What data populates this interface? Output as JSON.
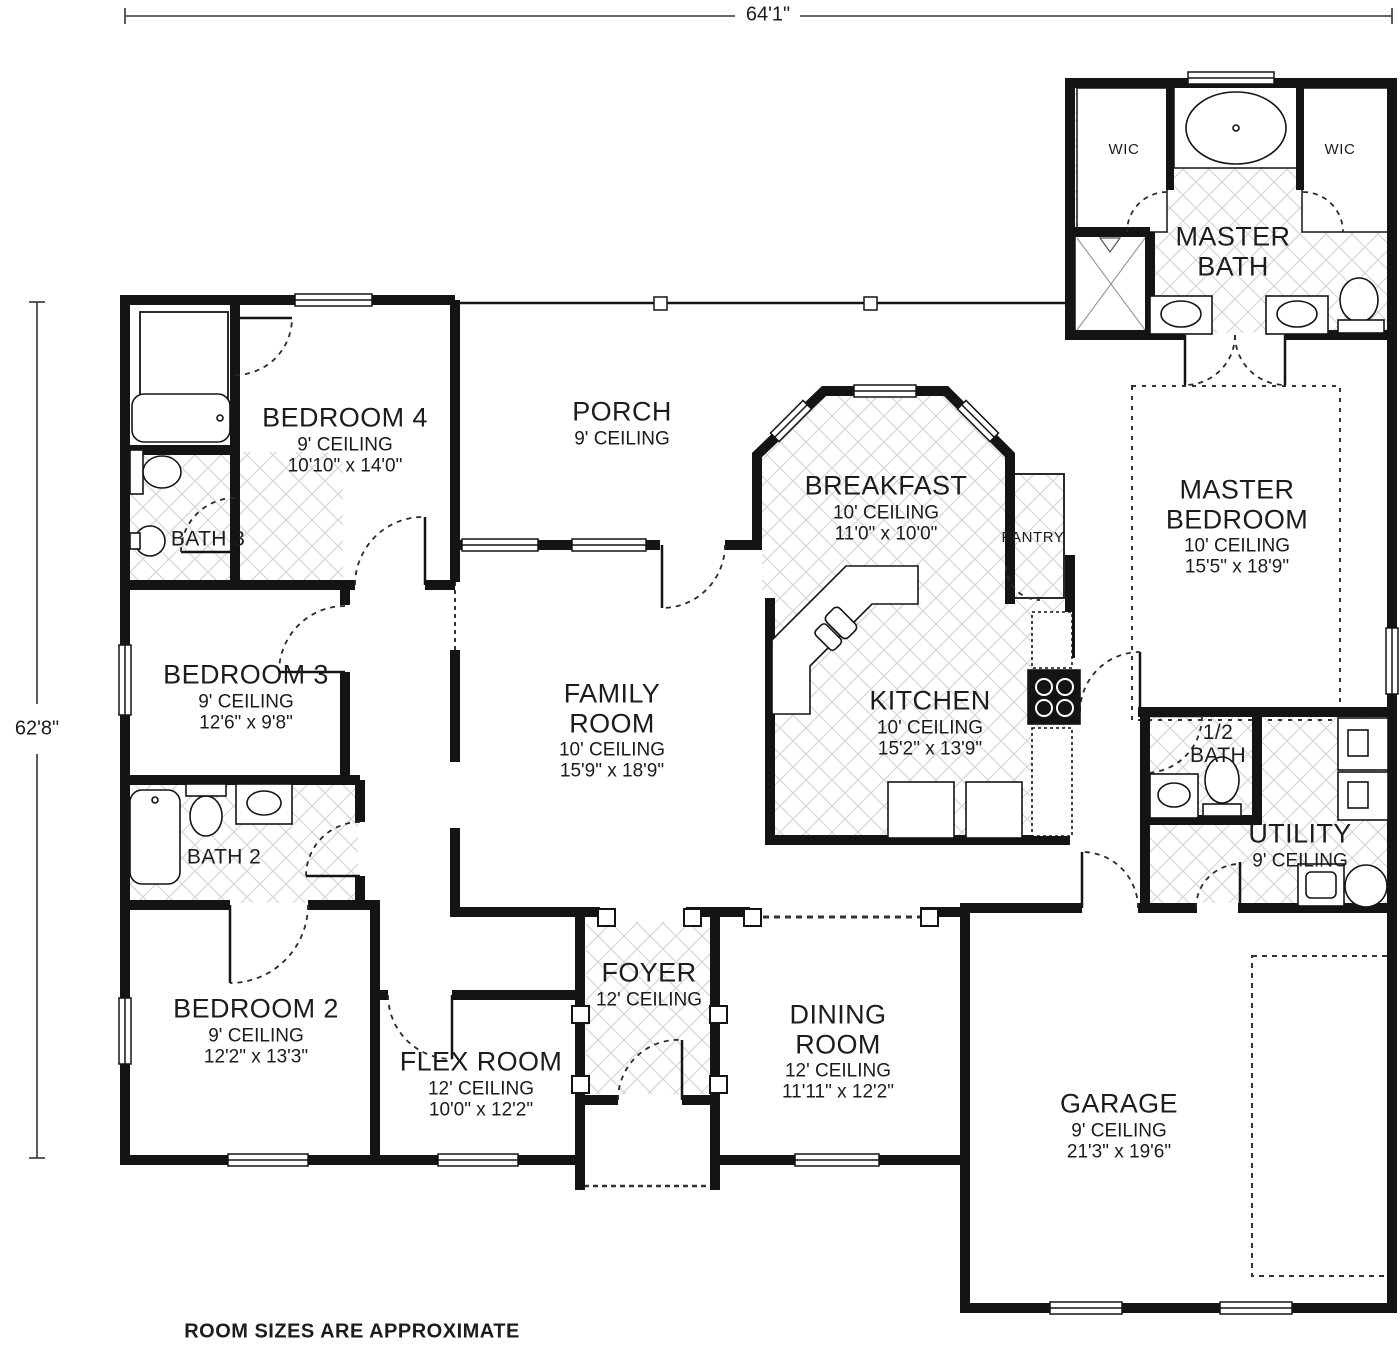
{
  "dimensions": {
    "overall_width": "64'1\"",
    "overall_height": "62'8\""
  },
  "footnote": "ROOM SIZES ARE APPROXIMATE",
  "rooms": {
    "master_bath": {
      "name": [
        "MASTER",
        "BATH"
      ],
      "details": []
    },
    "wic_left": {
      "name": [
        "WIC"
      ],
      "details": []
    },
    "wic_right": {
      "name": [
        "WIC"
      ],
      "details": []
    },
    "bedroom4": {
      "name": [
        "BEDROOM 4"
      ],
      "details": [
        "9' CEILING",
        "10'10\" x 14'0\""
      ]
    },
    "porch": {
      "name": [
        "PORCH"
      ],
      "details": [
        "9' CEILING"
      ]
    },
    "breakfast": {
      "name": [
        "BREAKFAST"
      ],
      "details": [
        "10' CEILING",
        "11'0\" x 10'0\""
      ]
    },
    "pantry": {
      "name": [
        "PANTRY"
      ],
      "details": []
    },
    "master_bedroom": {
      "name": [
        "MASTER",
        "BEDROOM"
      ],
      "details": [
        "10' CEILING",
        "15'5\" x 18'9\""
      ]
    },
    "bath3": {
      "name": [
        "BATH 3"
      ],
      "details": []
    },
    "bedroom3": {
      "name": [
        "BEDROOM 3"
      ],
      "details": [
        "9' CEILING",
        "12'6\" x 9'8\""
      ]
    },
    "family_room": {
      "name": [
        "FAMILY",
        "ROOM"
      ],
      "details": [
        "10' CEILING",
        "15'9\" x 18'9\""
      ]
    },
    "kitchen": {
      "name": [
        "KITCHEN"
      ],
      "details": [
        "10' CEILING",
        "15'2\" x 13'9\""
      ]
    },
    "half_bath": {
      "name": [
        "1/2",
        "BATH"
      ],
      "details": []
    },
    "utility": {
      "name": [
        "UTILITY"
      ],
      "details": [
        "9' CEILING"
      ]
    },
    "bath2": {
      "name": [
        "BATH 2"
      ],
      "details": []
    },
    "bedroom2": {
      "name": [
        "BEDROOM 2"
      ],
      "details": [
        "9' CEILING",
        "12'2\" x 13'3\""
      ]
    },
    "flex_room": {
      "name": [
        "FLEX ROOM"
      ],
      "details": [
        "12' CEILING",
        "10'0\" x 12'2\""
      ]
    },
    "foyer": {
      "name": [
        "FOYER"
      ],
      "details": [
        "12' CEILING"
      ]
    },
    "dining_room": {
      "name": [
        "DINING",
        "ROOM"
      ],
      "details": [
        "12' CEILING",
        "11'11\" x 12'2\""
      ]
    },
    "garage": {
      "name": [
        "GARAGE"
      ],
      "details": [
        "9' CEILING",
        "21'3\" x 19'6\""
      ]
    }
  },
  "colors": {
    "wall": "#141414",
    "hatch": "#d7d7d7",
    "text": "#1c1c1c"
  }
}
